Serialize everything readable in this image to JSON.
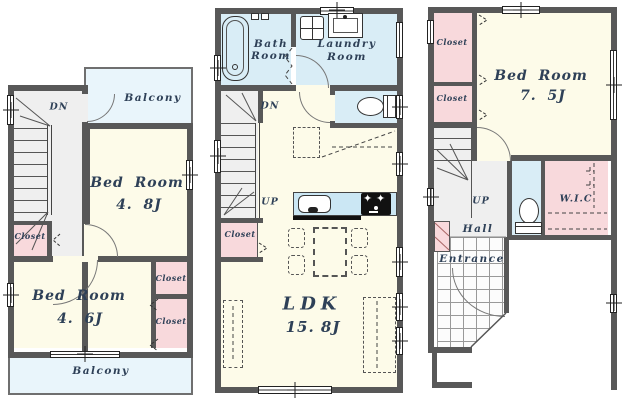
{
  "colors": {
    "wall": "#585858",
    "room_fill": "#FDFBE9",
    "wet_area_fill": "#D9EDF6",
    "balcony_fill": "#E9F5FB",
    "closet_fill": "#F8D9DC",
    "hall_fill": "#EFEFEF",
    "kitchen_counter_fill": "#CBE7F4",
    "label_text": "#2E4057"
  },
  "floors": {
    "left": {
      "balcony_top": "Balcony",
      "stairs_down": "DN",
      "bedroom_a_name": "Bed Room",
      "bedroom_a_size": "4. 8J",
      "closet_hall": "Closet",
      "bedroom_b_name": "Bed Room",
      "bedroom_b_size": "4. 6J",
      "closet_a": "Closet",
      "closet_b": "Closet",
      "balcony_bottom": "Balcony"
    },
    "middle": {
      "bath_line1": "Bath",
      "bath_line2": "Room",
      "laundry_line1": "Laundry",
      "laundry_line2": "Room",
      "stairs_down": "DN",
      "stairs_up": "UP",
      "closet": "Closet",
      "ldk_name": "LDK",
      "ldk_size": "15. 8J"
    },
    "right": {
      "closet_a": "Closet",
      "closet_b": "Closet",
      "bedroom_name": "Bed Room",
      "bedroom_size": "7. 5J",
      "stairs_up": "UP",
      "hall": "Hall",
      "entrance": "Entrance",
      "wic": "W.I.C"
    }
  }
}
